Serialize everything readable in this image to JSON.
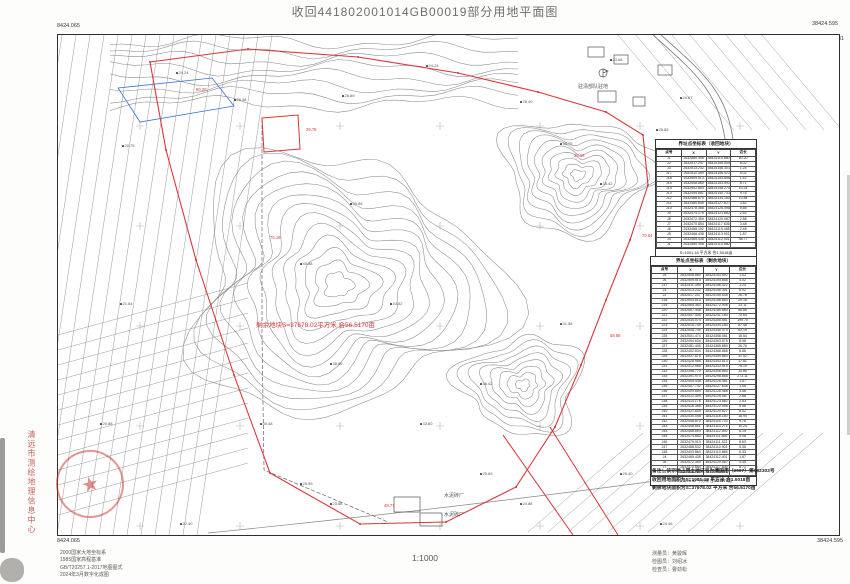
{
  "title": "收回441802001014GB00019部分用地平面图",
  "scale_text": "1:1000",
  "frame": {
    "tl_top": "8424.065",
    "tl_bottom": "2632.531",
    "tr_top": "38424.595",
    "tr_bottom": "2632.531",
    "bl_top": "2632.156",
    "bl_bottom": "8424.065",
    "br_top": "2632.156",
    "br_bottom": "38424.595"
  },
  "colors": {
    "boundary_red": "#d9363b",
    "blue": "#3a6fd8",
    "stamp_red": "#c0392b",
    "contour": "#8a8a8a",
    "strip": "#9a9a9a"
  },
  "stamp": {
    "org": "清远市测绘地理信息中心"
  },
  "map_texts": [
    {
      "name": "label-garrison",
      "x": 520,
      "y": 48,
      "t": "驻清部队驻地",
      "c": "#555",
      "s": 5
    },
    {
      "name": "label-cement-plant-1",
      "x": 386,
      "y": 457,
      "t": "水泥砖厂",
      "c": "#555",
      "s": 5
    },
    {
      "name": "label-cement-plant-2",
      "x": 386,
      "y": 476,
      "t": "水泥砖厂",
      "c": "#555",
      "s": 5
    },
    {
      "name": "label-remain-area",
      "x": 198,
      "y": 284,
      "t": "剩余地块S=37678.02平方米 合56.5170亩",
      "c": "#d9363b",
      "s": 6.5
    }
  ],
  "boundary_labels": [
    {
      "x": 138,
      "y": 52,
      "v": "60.20"
    },
    {
      "x": 248,
      "y": 92,
      "v": "26.78"
    },
    {
      "x": 516,
      "y": 118,
      "v": "29.18"
    },
    {
      "x": 552,
      "y": 298,
      "v": "58.86"
    },
    {
      "x": 326,
      "y": 468,
      "v": "48.77"
    },
    {
      "x": 212,
      "y": 200,
      "v": "76.19"
    },
    {
      "x": 584,
      "y": 198,
      "v": "70.64"
    }
  ],
  "spot_heights": [
    {
      "x": 118,
      "y": 35,
      "v": "24.24"
    },
    {
      "x": 176,
      "y": 62,
      "v": "26.48"
    },
    {
      "x": 64,
      "y": 108,
      "v": "20.79"
    },
    {
      "x": 284,
      "y": 58,
      "v": "28.89"
    },
    {
      "x": 368,
      "y": 28,
      "v": "24.24"
    },
    {
      "x": 462,
      "y": 64,
      "v": "26.40"
    },
    {
      "x": 552,
      "y": 22,
      "v": "23.68"
    },
    {
      "x": 622,
      "y": 60,
      "v": "24.67"
    },
    {
      "x": 502,
      "y": 106,
      "v": "30.75"
    },
    {
      "x": 542,
      "y": 146,
      "v": "33.42"
    },
    {
      "x": 598,
      "y": 92,
      "v": "28.85"
    },
    {
      "x": 292,
      "y": 166,
      "v": "35.86"
    },
    {
      "x": 242,
      "y": 226,
      "v": "40.88"
    },
    {
      "x": 332,
      "y": 266,
      "v": "43.52"
    },
    {
      "x": 272,
      "y": 326,
      "v": "38.86"
    },
    {
      "x": 202,
      "y": 386,
      "v": "30.48"
    },
    {
      "x": 362,
      "y": 386,
      "v": "33.80"
    },
    {
      "x": 422,
      "y": 346,
      "v": "36.42"
    },
    {
      "x": 502,
      "y": 286,
      "v": "31.58"
    },
    {
      "x": 242,
      "y": 446,
      "v": "25.99"
    },
    {
      "x": 272,
      "y": 466,
      "v": "23.88"
    },
    {
      "x": 422,
      "y": 436,
      "v": "25.69"
    },
    {
      "x": 462,
      "y": 466,
      "v": "24.88"
    },
    {
      "x": 562,
      "y": 436,
      "v": "26.40"
    },
    {
      "x": 602,
      "y": 486,
      "v": "24.46"
    },
    {
      "x": 62,
      "y": 266,
      "v": "21.54"
    },
    {
      "x": 42,
      "y": 386,
      "v": "20.88"
    },
    {
      "x": 122,
      "y": 486,
      "v": "22.40"
    },
    {
      "x": 642,
      "y": 266,
      "v": "27.86"
    },
    {
      "x": 672,
      "y": 386,
      "v": "25.48"
    }
  ],
  "tables": {
    "reclaim": {
      "title": "界址点坐标表（收回地块）",
      "headers": [
        "点号",
        "X",
        "Y",
        "边长"
      ],
      "rows": [
        [
          "J1",
          "2632580.498",
          "38424110.880",
          "60.20"
        ],
        [
          "J2",
          "2632517.247",
          "38424155.545",
          "8.02"
        ],
        [
          "J3",
          "2632513.232",
          "38424156.301",
          "1.24"
        ],
        [
          "J17",
          "2632511.399",
          "38424156.422",
          "4.02"
        ],
        [
          "J16",
          "2632509.513",
          "38424154.856",
          "1.42"
        ],
        [
          "J15",
          "2632508.860",
          "38424153.592",
          "8.71"
        ],
        [
          "J14",
          "2632502.853",
          "38424148.274",
          "10.24"
        ],
        [
          "J13",
          "2632495.851",
          "38424140.733",
          "9.76"
        ],
        [
          "J12",
          "2632488.870",
          "38424134.180",
          "10.84"
        ],
        [
          "J11",
          "2632480.845",
          "38424127.627",
          "3.52"
        ],
        [
          "J10",
          "2632478.388",
          "38424125.498",
          "5.58"
        ],
        [
          "J9",
          "2632474.176",
          "38424121.882",
          "2.53"
        ],
        [
          "J8",
          "2632472.359",
          "38424120.087",
          "2.88"
        ],
        [
          "J7",
          "2632470.854",
          "38424117.636",
          "3.48"
        ],
        [
          "J6",
          "2632468.152",
          "38424115.468",
          "2.48"
        ],
        [
          "J5",
          "2632466.438",
          "38424113.901",
          "1.87"
        ],
        [
          "J4",
          "2632465.438",
          "38424112.401",
          "48.77"
        ],
        [
          "J1",
          "2632580.498",
          "38424110.880",
          ""
        ]
      ],
      "sum": "S=1001.18 平方米 合1.5018亩"
    },
    "remain": {
      "title": "界址点坐标表（剩余地块）",
      "headers": [
        "点号",
        "X",
        "Y",
        "边长"
      ],
      "rows": [
        [
          "J5",
          "2632508.860",
          "38424153.592",
          "1.42"
        ],
        [
          "J6",
          "2632509.513",
          "38424154.856",
          "4.02"
        ],
        [
          "J17",
          "2632511.399",
          "38424156.422",
          "1.24"
        ],
        [
          "J3",
          "2632513.232",
          "38424156.301",
          "8.02"
        ],
        [
          "J2",
          "2632517.247",
          "38424155.545",
          "26.78"
        ],
        [
          "J18",
          "2632543.810",
          "38424158.860",
          "29.18"
        ],
        [
          "J19",
          "2632569.363",
          "38424172.908",
          "13.11"
        ],
        [
          "J20",
          "2632567.408",
          "38424185.880",
          "58.86"
        ],
        [
          "J21",
          "2632547.408",
          "38424241.180",
          "70.64"
        ],
        [
          "J22",
          "2632534.574",
          "38424308.581",
          "199.70"
        ],
        [
          "J23",
          "2632516.745",
          "38424334.180",
          "87.48"
        ],
        [
          "J24",
          "2632508.745",
          "38424345.474",
          "62.15"
        ],
        [
          "J25",
          "2632501.474",
          "38424358.081",
          "15.54"
        ],
        [
          "J26",
          "2632494.634",
          "38424363.575",
          "8.98"
        ],
        [
          "J27",
          "2632481.408",
          "38424365.880",
          "26.76"
        ],
        [
          "J28",
          "2632452.834",
          "38424368.868",
          "8.86"
        ],
        [
          "J29",
          "2632437.875",
          "38424359.860",
          "31.52"
        ],
        [
          "J30",
          "2632428.985",
          "38424343.813",
          "17.81"
        ],
        [
          "J31",
          "2632412.985",
          "38424333.919",
          "76.19"
        ],
        [
          "J32",
          "2632398.770",
          "38424308.863",
          "10.85"
        ],
        [
          "J33",
          "2632391.974",
          "38424298.868",
          "273.11"
        ],
        [
          "J34",
          "2632405.438",
          "38424128.481",
          "1.87"
        ],
        [
          "J35",
          "2632407.742",
          "38424127.636",
          "1.48"
        ],
        [
          "J36",
          "2632409.854",
          "38424126.468",
          "3.48"
        ],
        [
          "J37",
          "2632412.359",
          "38424125.087",
          "2.88"
        ],
        [
          "J38",
          "2632414.176",
          "38424123.882",
          "2.53"
        ],
        [
          "J39",
          "2632416.388",
          "38424122.498",
          "5.58"
        ],
        [
          "J40",
          "2632421.845",
          "38424120.627",
          "8.42"
        ],
        [
          "J41",
          "2632430.048",
          "38424118.180",
          "18.94"
        ],
        [
          "J42",
          "2632448.870",
          "38424115.733",
          "9.76"
        ],
        [
          "J43",
          "2632458.851",
          "38424114.274",
          "10.24"
        ],
        [
          "J44",
          "2632468.853",
          "38424112.592",
          "6.15"
        ],
        [
          "J45",
          "2632474.860",
          "38424111.856",
          "5.08"
        ],
        [
          "J46",
          "2632479.913",
          "38424111.422",
          "8.63"
        ],
        [
          "J47",
          "2632488.532",
          "38424110.901",
          "5.36"
        ],
        [
          "J48",
          "2632493.864",
          "38424110.885",
          "6.33"
        ],
        [
          "J4",
          "2632465.438",
          "38424112.401",
          "1.87"
        ],
        [
          "J8",
          "2632472.359",
          "38424120.087",
          "4.35"
        ],
        [
          "J7",
          "2632470.854",
          "38424117.636",
          "8.71"
        ],
        [
          "J5",
          "2632508.860",
          "38424153.592",
          ""
        ]
      ],
      "sum": "S=37678.02 平方米 合56.5170亩"
    }
  },
  "notes": [
    "备注：该宗地占用土地证号为清国用（2007）第092303号",
    "收回用地面积为S=1001.18 平方米 合1.5018亩",
    "剩余地块面积为S=37678.02 平方米 合56.5170亩"
  ],
  "footer_left_lines": [
    "2000国家大地坐标系",
    "1985国家高程基准",
    "GB/T20257.1-2017地图图式",
    "2024年3月数字化成图"
  ],
  "footer_right_lines": [
    "测量员：黄骏晖",
    "检图员：刘绍冰",
    "检查员：曹劲松"
  ]
}
